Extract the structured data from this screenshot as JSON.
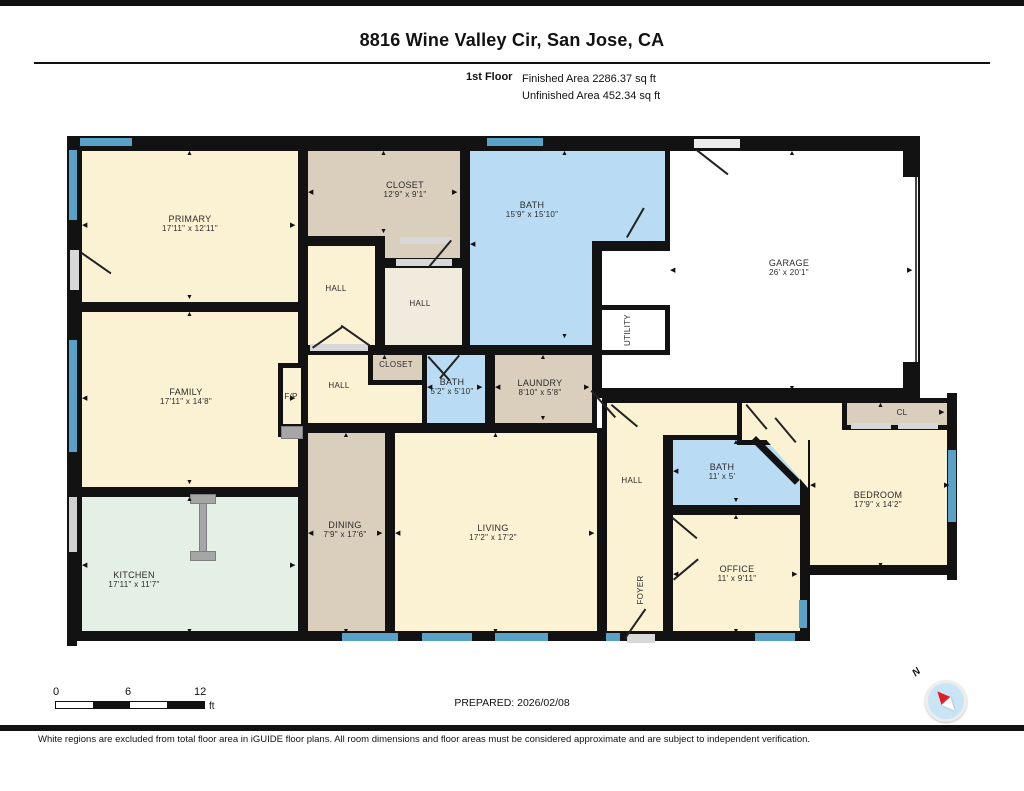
{
  "header": {
    "address": "8816 Wine Valley Cir, San Jose, CA",
    "floor_label": "1st Floor",
    "finished_area": "Finished Area 2286.37 sq ft",
    "unfinished_area": "Unfinished Area 452.34 sq ft"
  },
  "footer": {
    "scale_0": "0",
    "scale_6": "6",
    "scale_12": "12",
    "scale_unit": "ft",
    "prepared": "PREPARED: 2026/02/08",
    "compass_n": "N",
    "disclaimer": "White regions are excluded from total floor area in iGUIDE floor plans. All room dimensions and floor areas must be considered approximate and are subject to independent verification."
  },
  "colors": {
    "wall": "#121212",
    "cream": "#FBF1D3",
    "tan": "#D9CFBC",
    "beige": "#F0EBDC",
    "blue": "#B9DCF4",
    "mint": "#E4EFE6",
    "white": "#FFFFFF",
    "window": "#5AA1C8",
    "door": "#D8D8D8",
    "island": "#A6A6A6"
  },
  "plan": {
    "rooms": [
      {
        "id": "primary",
        "label": "PRIMARY",
        "dims": "17'11\" x 12'11\"",
        "rects": [
          [
            77,
            146,
            226,
            161
          ]
        ],
        "bb": [
          82,
          151,
          216,
          151
        ],
        "cx": 190,
        "cy": 224,
        "fill": "cream",
        "arrows": "tblr"
      },
      {
        "id": "family",
        "label": "FAMILY",
        "dims": "17'11\" x 14'8\"",
        "rects": [
          [
            77,
            307,
            226,
            185
          ]
        ],
        "bb": [
          82,
          312,
          216,
          175
        ],
        "cx": 186,
        "cy": 397,
        "fill": "cream",
        "arrows": "tblr"
      },
      {
        "id": "kitchen",
        "label": "KITCHEN",
        "dims": "17'11\" x 11'7\"",
        "rects": [
          [
            77,
            492,
            226,
            149
          ]
        ],
        "bb": [
          82,
          497,
          216,
          139
        ],
        "cx": 134,
        "cy": 580,
        "fill": "mint",
        "arrows": "tblr"
      },
      {
        "id": "closet-top",
        "label": "CLOSET",
        "dims": "12'9\" x 9'1\"",
        "rects": [
          [
            303,
            146,
            162,
            95
          ],
          [
            380,
            146,
            85,
            117
          ]
        ],
        "bb": [
          308,
          151,
          152,
          85
        ],
        "cx": 405,
        "cy": 190,
        "fill": "tan",
        "arrows": "tblr"
      },
      {
        "id": "hall-a",
        "label": "HALL",
        "rects": [
          [
            303,
            241,
            77,
            109
          ]
        ],
        "bb": [
          308,
          246,
          67,
          99
        ],
        "cx": 336,
        "cy": 289,
        "fill": "cream",
        "small": true
      },
      {
        "id": "hall-b",
        "label": "HALL",
        "rects": [
          [
            380,
            263,
            87,
            87
          ]
        ],
        "bb": [
          385,
          268,
          77,
          77
        ],
        "cx": 420,
        "cy": 304,
        "fill": "beige",
        "small": true
      },
      {
        "id": "bath-top",
        "label": "BATH",
        "dims": "15'9\" x 15'10\"",
        "rects": [
          [
            465,
            146,
            205,
            100
          ],
          [
            465,
            146,
            132,
            204
          ]
        ],
        "bb": [
          470,
          151,
          190,
          190
        ],
        "cx": 532,
        "cy": 210,
        "fill": "blue",
        "arrows": "tblr"
      },
      {
        "id": "garage",
        "label": "GARAGE",
        "dims": "26' x 20'1\"",
        "rects": [
          [
            665,
            146,
            255,
            252
          ],
          [
            597,
            246,
            78,
            152
          ]
        ],
        "bb": [
          670,
          151,
          245,
          242
        ],
        "cx": 789,
        "cy": 268,
        "fill": "white",
        "arrows": "tblr"
      },
      {
        "id": "utility",
        "label": "UTILITY",
        "rects": [
          [
            597,
            305,
            73,
            50
          ]
        ],
        "bb": [
          602,
          310,
          63,
          40
        ],
        "cx": 628,
        "cy": 330,
        "fill": "white",
        "rot": true,
        "small": true
      },
      {
        "id": "hall-c",
        "label": "HALL",
        "rects": [
          [
            303,
            350,
            164,
            78
          ]
        ],
        "bb": [
          308,
          355,
          154,
          30
        ],
        "cx": 339,
        "cy": 386,
        "fill": "cream",
        "small": true,
        "arrows": "t"
      },
      {
        "id": "closet-small",
        "label": "CLOSET",
        "rects": [
          [
            368,
            350,
            59,
            35
          ]
        ],
        "bb": [
          373,
          355,
          49,
          25
        ],
        "cx": 396,
        "cy": 365,
        "fill": "tan",
        "small": true
      },
      {
        "id": "bath-small",
        "label": "BATH",
        "dims": "5'2\" x 5'10\"",
        "rects": [
          [
            422,
            350,
            68,
            78
          ]
        ],
        "bb": [
          427,
          355,
          58,
          68
        ],
        "cx": 452,
        "cy": 387,
        "fill": "blue",
        "arrows": "lr"
      },
      {
        "id": "laundry",
        "label": "LAUNDRY",
        "dims": "8'10\" x 5'8\"",
        "rects": [
          [
            490,
            350,
            107,
            78
          ]
        ],
        "bb": [
          495,
          355,
          97,
          68
        ],
        "cx": 540,
        "cy": 388,
        "fill": "tan",
        "arrows": "tblr"
      },
      {
        "id": "dining",
        "label": "DINING",
        "dims": "7'9\" x 17'6\"",
        "rects": [
          [
            303,
            428,
            87,
            213
          ]
        ],
        "bb": [
          308,
          433,
          77,
          203
        ],
        "cx": 345,
        "cy": 530,
        "fill": "tan",
        "arrows": "tblr"
      },
      {
        "id": "living",
        "label": "LIVING",
        "dims": "17'2\" x 17'2\"",
        "rects": [
          [
            390,
            428,
            212,
            213
          ]
        ],
        "bb": [
          395,
          433,
          202,
          203
        ],
        "cx": 493,
        "cy": 533,
        "fill": "cream",
        "arrows": "tblr"
      },
      {
        "id": "hall-center",
        "label": "HALL",
        "rects": [
          [
            602,
            398,
            66,
            243
          ],
          [
            602,
            398,
            140,
            42
          ]
        ],
        "bb": [
          607,
          403,
          56,
          233
        ],
        "cx": 632,
        "cy": 481,
        "fill": "cream",
        "small": true
      },
      {
        "id": "foyer",
        "label": "FOYER",
        "rects": [],
        "bb": [
          607,
          540,
          56,
          96
        ],
        "cx": 641,
        "cy": 590,
        "fill": "cream",
        "rot": true,
        "small": true
      },
      {
        "id": "bath-right",
        "label": "BATH",
        "dims": "11' x 5'",
        "rects": [
          [
            668,
            435,
            137,
            75
          ]
        ],
        "bb": [
          673,
          440,
          127,
          65
        ],
        "cx": 722,
        "cy": 472,
        "fill": "blue",
        "arrows": "tbl"
      },
      {
        "id": "office",
        "label": "OFFICE",
        "dims": "11' x 9'11\"",
        "rects": [
          [
            668,
            510,
            137,
            131
          ]
        ],
        "bb": [
          673,
          515,
          127,
          121
        ],
        "cx": 737,
        "cy": 574,
        "fill": "cream",
        "arrows": "tblr"
      },
      {
        "id": "bedroom",
        "label": "BEDROOM",
        "dims": "17'9\" x 14'2\"",
        "rects": [
          [
            805,
            398,
            152,
            177
          ],
          [
            737,
            398,
            105,
            47
          ]
        ],
        "bb": [
          810,
          403,
          142,
          167
        ],
        "cx": 878,
        "cy": 500,
        "fill": "cream",
        "arrows": "tblr"
      },
      {
        "id": "cl",
        "label": "CL",
        "rects": [
          [
            842,
            398,
            110,
            32
          ]
        ],
        "bb": [
          847,
          403,
          100,
          22
        ],
        "cx": 902,
        "cy": 413,
        "fill": "tan",
        "small": true,
        "arrows": "r"
      },
      {
        "id": "fp",
        "label": "F/P",
        "rects": [],
        "bb": [
          283,
          368,
          18,
          56
        ],
        "cx": 291,
        "cy": 397,
        "fill": "cream",
        "small": true
      }
    ],
    "overlays": [
      {
        "r": [
          67,
          136,
          853,
          10
        ],
        "bg": "#121212"
      },
      {
        "r": [
          67,
          136,
          10,
          510
        ],
        "bg": "#121212"
      },
      {
        "r": [
          67,
          631,
          743,
          10
        ],
        "bg": "#121212"
      },
      {
        "r": [
          597,
          388,
          323,
          10
        ],
        "bg": "#121212"
      },
      {
        "r": [
          947,
          393,
          10,
          187
        ],
        "bg": "#121212"
      },
      {
        "r": [
          805,
          565,
          152,
          10
        ],
        "bg": "#121212"
      },
      {
        "r": [
          800,
          570,
          10,
          71
        ],
        "bg": "#121212"
      },
      {
        "r": [
          908,
          174,
          10,
          188
        ],
        "bg": "#FFFFFF"
      },
      {
        "r": [
          915,
          174,
          2,
          188
        ],
        "bg": "#444444"
      },
      {
        "r": [
          903,
          141,
          17,
          36
        ],
        "bg": "#121212"
      },
      {
        "r": [
          903,
          362,
          17,
          36
        ],
        "bg": "#121212"
      },
      {
        "r": [
          278,
          363,
          28,
          74
        ],
        "bg": "#121212"
      },
      {
        "r": [
          283,
          368,
          18,
          56
        ],
        "bg": "#FBF1D3"
      },
      {
        "r": [
          281,
          426,
          22,
          13
        ],
        "bg": "#A6A6A6",
        "bd": true
      },
      {
        "r": [
          190,
          494,
          26,
          10
        ],
        "bg": "#A6A6A6",
        "bd": true
      },
      {
        "r": [
          190,
          551,
          26,
          10
        ],
        "bg": "#A6A6A6",
        "bd": true
      },
      {
        "r": [
          199,
          503,
          8,
          49
        ],
        "bg": "#A6A6A6",
        "bd": true
      },
      {
        "r": [
          752,
          433,
          56,
          55
        ],
        "bg": "#FBF1D3",
        "clip": "polygon(15% 0, 100% 0, 100% 100%)"
      },
      {
        "r": [
          756,
          436,
          62,
          7
        ],
        "bg": "#121212",
        "rot": 45
      },
      {
        "r": [
          851,
          423,
          40,
          6
        ],
        "bg": "#D8D8D8"
      },
      {
        "r": [
          898,
          423,
          40,
          6
        ],
        "bg": "#D8D8D8"
      },
      {
        "r": [
          627,
          634,
          28,
          9
        ],
        "bg": "#D8D8D8"
      },
      {
        "r": [
          694,
          139,
          46,
          9
        ],
        "bg": "#ECECEC"
      },
      {
        "r": [
          400,
          237,
          52,
          7
        ],
        "bg": "#D8D8D8"
      },
      {
        "r": [
          396,
          259,
          56,
          7
        ],
        "bg": "#D8D8D8"
      },
      {
        "r": [
          310,
          344,
          58,
          7
        ],
        "bg": "#D8D8D8"
      },
      {
        "r": [
          70,
          250,
          9,
          40
        ],
        "bg": "#D8D8D8"
      }
    ],
    "windows": [
      {
        "r": [
          80,
          138,
          52,
          8
        ]
      },
      {
        "r": [
          487,
          138,
          56,
          8
        ]
      },
      {
        "r": [
          69,
          150,
          8,
          70
        ]
      },
      {
        "r": [
          69,
          340,
          8,
          112
        ]
      },
      {
        "r": [
          69,
          497,
          8,
          55
        ],
        "c": "#D0D0D0"
      },
      {
        "r": [
          342,
          633,
          56,
          8
        ]
      },
      {
        "r": [
          422,
          633,
          50,
          8
        ]
      },
      {
        "r": [
          495,
          633,
          53,
          8
        ]
      },
      {
        "r": [
          606,
          633,
          14,
          8
        ]
      },
      {
        "r": [
          755,
          633,
          40,
          8
        ]
      },
      {
        "r": [
          799,
          600,
          8,
          28
        ]
      },
      {
        "r": [
          948,
          450,
          8,
          72
        ]
      }
    ],
    "doors": [
      {
        "p": [
          82,
          252
        ],
        "len": 36,
        "deg": 35
      },
      {
        "p": [
          312,
          347
        ],
        "len": 36,
        "deg": -35
      },
      {
        "p": [
          370,
          347
        ],
        "len": 36,
        "deg": -145
      },
      {
        "p": [
          452,
          241
        ],
        "len": 34,
        "deg": 130
      },
      {
        "p": [
          697,
          149
        ],
        "len": 40,
        "deg": 38
      },
      {
        "p": [
          626,
          237
        ],
        "len": 34,
        "deg": -60
      },
      {
        "p": [
          429,
          356
        ],
        "len": 32,
        "deg": 48
      },
      {
        "p": [
          460,
          356
        ],
        "len": 30,
        "deg": 130
      },
      {
        "p": [
          592,
          390
        ],
        "len": 36,
        "deg": 48
      },
      {
        "p": [
          612,
          404
        ],
        "len": 34,
        "deg": 40
      },
      {
        "p": [
          624,
          638
        ],
        "len": 36,
        "deg": -55
      },
      {
        "p": [
          747,
          404
        ],
        "len": 32,
        "deg": 50
      },
      {
        "p": [
          795,
          443
        ],
        "len": 32,
        "deg": -130
      },
      {
        "p": [
          673,
          517
        ],
        "len": 32,
        "deg": 40
      },
      {
        "p": [
          673,
          579
        ],
        "len": 32,
        "deg": -40
      }
    ]
  }
}
